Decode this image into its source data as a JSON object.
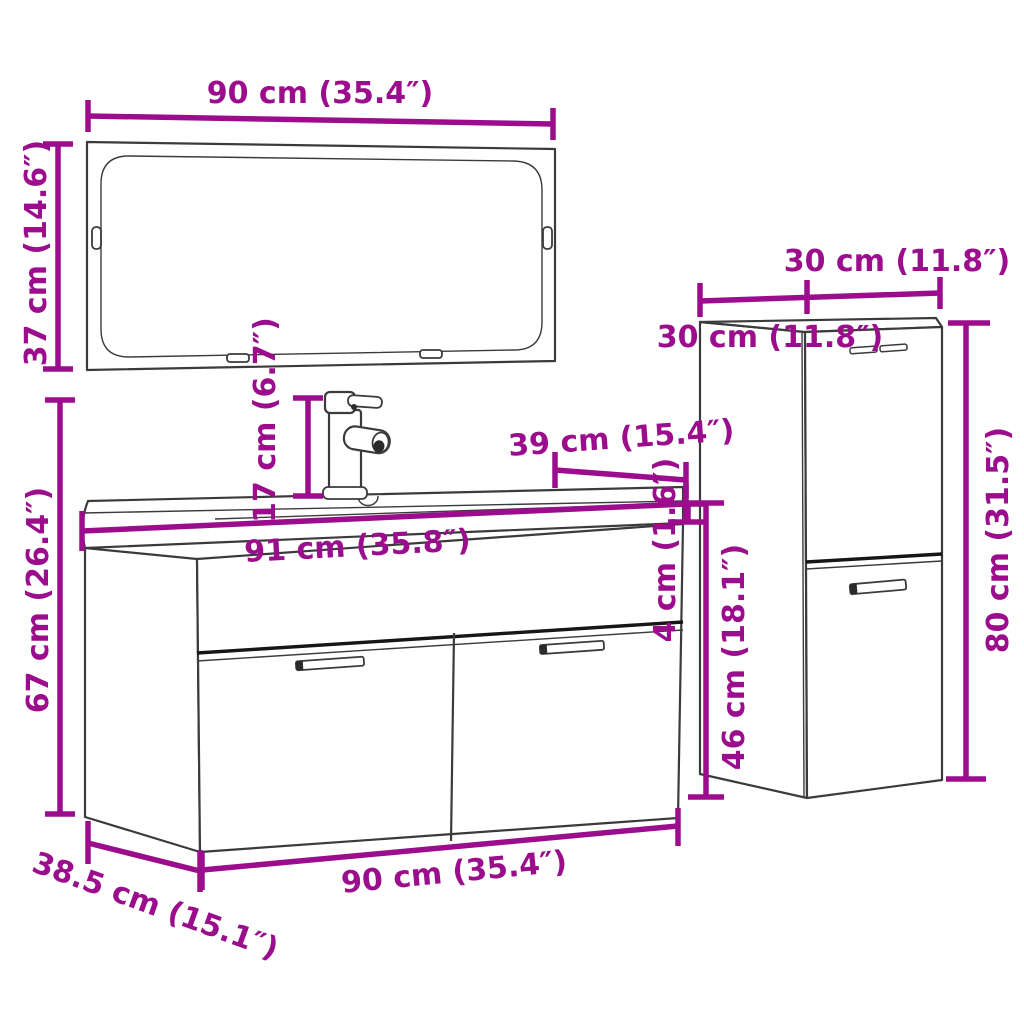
{
  "diagram": {
    "title": "bathroom-furniture-set-dimension-diagram",
    "background": "#ffffff",
    "colors": {
      "dimension": "#9b0d8c",
      "outline": "#3b3b3b",
      "separator": "#161616"
    },
    "parts": [
      "wall-mirror",
      "faucet",
      "wash-basin",
      "sink-cabinet-with-two-doors",
      "tall-side-cabinet-with-two-doors"
    ],
    "labels": {
      "mirror_width": "90 cm (35.4″)",
      "mirror_height": "37 cm (14.6″)",
      "cabinet_height": "67 cm (26.4″)",
      "faucet_height": "17 cm (6.7″)",
      "basin_width": "91 cm (35.8″)",
      "basin_depth": "39 cm (15.4″)",
      "basin_thickness": "4 cm (1.6″)",
      "side_cabinet_width": "30 cm (11.8″)",
      "side_cabinet_depth": "30 cm (11.8″)",
      "side_cabinet_height": "80 cm (31.5″)",
      "side_cabinet_lower_height": "46 cm (18.1″)",
      "cabinet_width": "90 cm (35.4″)",
      "cabinet_depth": "38.5 cm (15.1″)"
    }
  }
}
